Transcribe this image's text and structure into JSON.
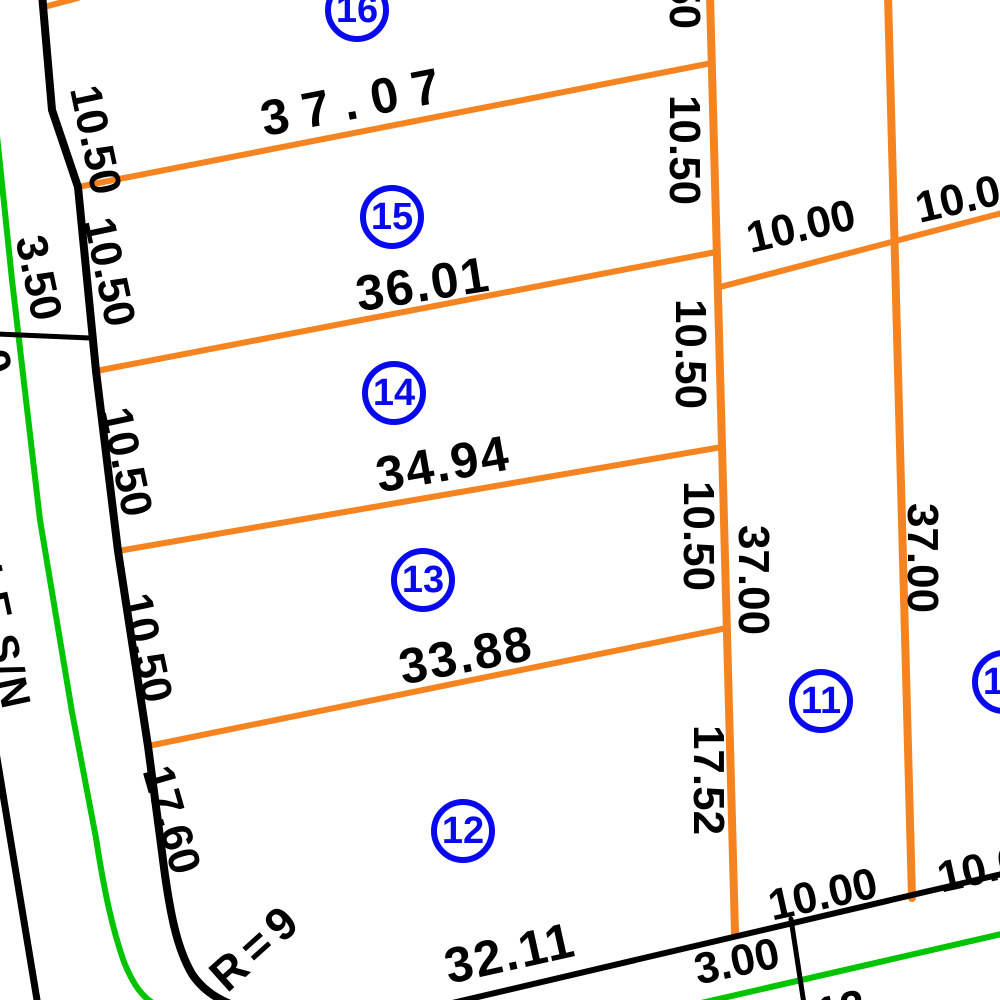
{
  "map_type": "cadastral-plat",
  "colors": {
    "background": "#ffffff",
    "road_line": "#000000",
    "lot_line": "#f5831f",
    "utility_line": "#00c400",
    "lot_badge": "#0909ee",
    "ink": "#000000"
  },
  "street": {
    "name": "CALLE S/N"
  },
  "lots": [
    {
      "number": "16"
    },
    {
      "number": "15"
    },
    {
      "number": "14"
    },
    {
      "number": "13"
    },
    {
      "number": "12"
    },
    {
      "number": "11"
    },
    {
      "number": "10"
    }
  ],
  "dimensions": {
    "lot_widths": [
      "37.07",
      "36.01",
      "34.94",
      "33.88",
      "32.11"
    ],
    "road_frontages": [
      "10.50",
      "10.50",
      "10.50",
      "10.50",
      "17.60"
    ],
    "side_depths": [
      "10.50",
      "10.50",
      "10.50",
      "10.50",
      "17.52"
    ],
    "block_depths": [
      "37.00",
      "37.00"
    ],
    "street_segments": [
      "10.00",
      "10.00",
      "10.00",
      "10.00",
      "3.00"
    ],
    "west_side": [
      "3.50",
      "0"
    ],
    "curve_radius": "R=9",
    "partial_fragment": "12"
  }
}
